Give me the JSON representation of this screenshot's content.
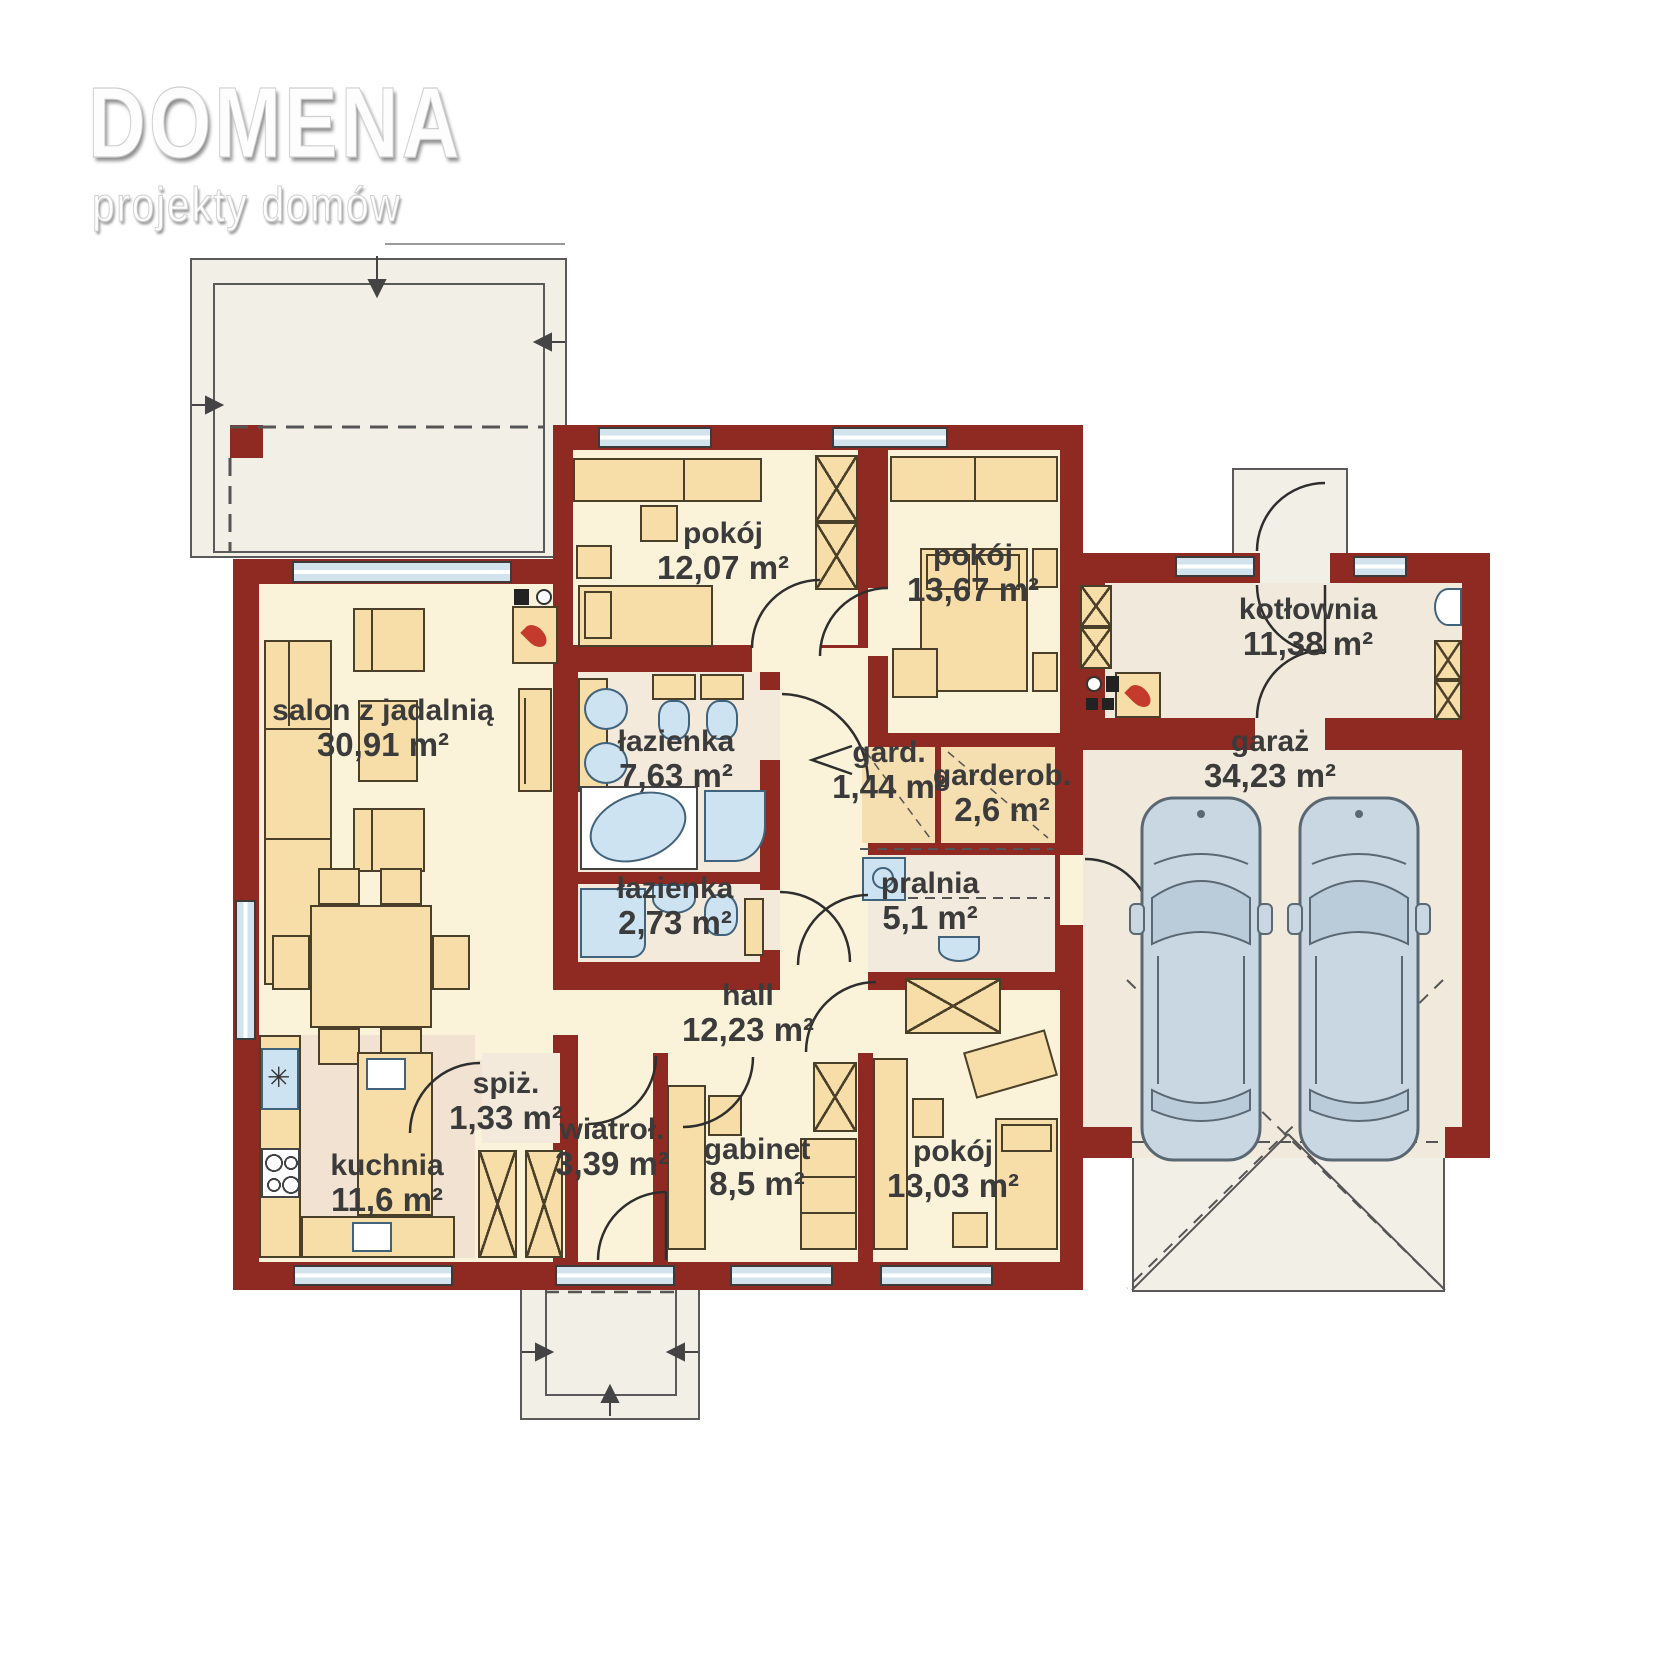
{
  "branding": {
    "title": "DOMENA",
    "subtitle": "projekty domów"
  },
  "rooms": [
    {
      "name": "salon z jadalnią",
      "area": "30,91 m²"
    },
    {
      "name": "pokój",
      "area": "12,07 m²"
    },
    {
      "name": "pokój",
      "area": "13,67 m²"
    },
    {
      "name": "łazienka",
      "area": "7,63 m²"
    },
    {
      "name": "łazienka",
      "area": "2,73 m²"
    },
    {
      "name": "gard.",
      "area": "1,44 m²"
    },
    {
      "name": "garderob.",
      "area": "2,6 m²"
    },
    {
      "name": "pralnia",
      "area": "5,1 m²"
    },
    {
      "name": "hall",
      "area": "12,23 m²"
    },
    {
      "name": "kotłownia",
      "area": "11,38 m²"
    },
    {
      "name": "garaż",
      "area": "34,23 m²"
    },
    {
      "name": "kuchnia",
      "area": "11,6 m²"
    },
    {
      "name": "spiż.",
      "area": "1,33 m²"
    },
    {
      "name": "wiatroł.",
      "area": "3,39 m²"
    },
    {
      "name": "gabinet",
      "area": "8,5 m²"
    },
    {
      "name": "pokój",
      "area": "13,03 m²"
    }
  ],
  "icons": {
    "freezer": "✳",
    "fireplace": "flame",
    "boiler": "flame"
  },
  "colors": {
    "wall": "#8E2A22",
    "floor": "#FAF2D9",
    "floor_tinted": "#F2EADC",
    "kitchen_floor": "#F1E2D2",
    "wardrobe_floor": "#F5DEB0",
    "furniture": "#F7DDA8",
    "window": "#D3E3ED",
    "fixture": "#CDE3F2",
    "outdoor": "#F2EFE7",
    "car": "#C9D7E3",
    "flame": "#C43B2E",
    "label_text": "#3B3B3B"
  }
}
